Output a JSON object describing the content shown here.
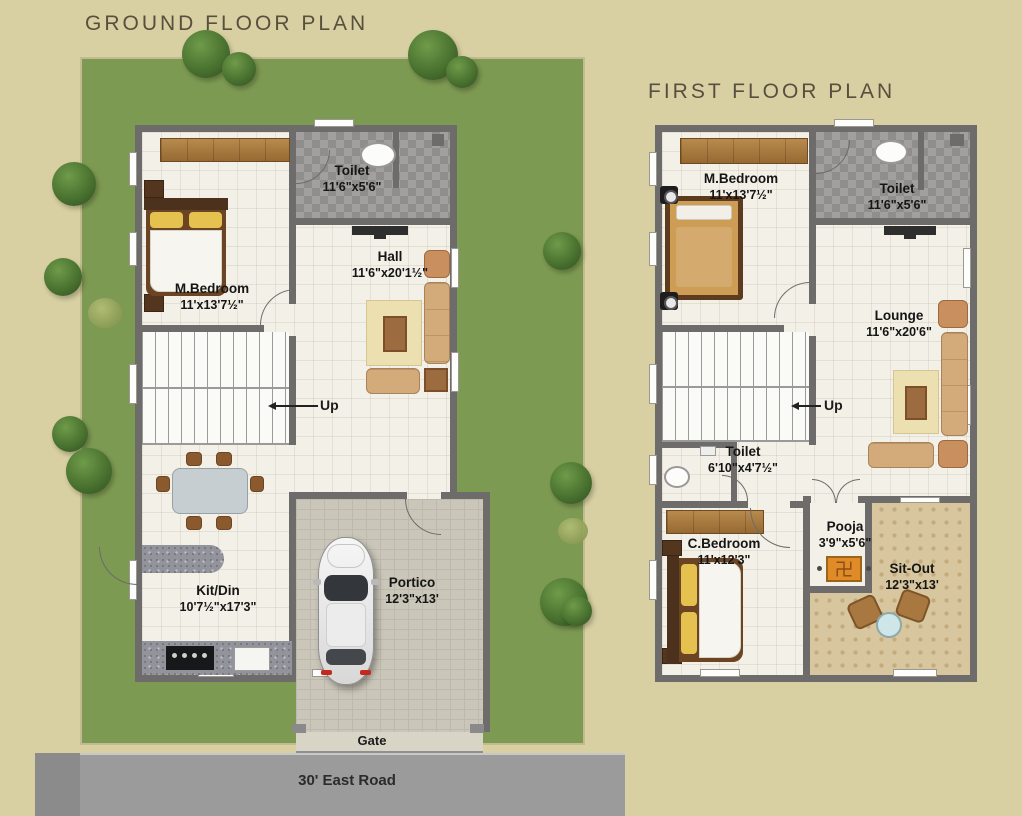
{
  "ground": {
    "title": "GROUND FLOOR PLAN",
    "mbedroom": {
      "name": "M.Bedroom",
      "dims": "11'x13'7½\""
    },
    "toilet": {
      "name": "Toilet",
      "dims": "11'6\"x5'6\""
    },
    "hall": {
      "name": "Hall",
      "dims": "11'6\"x20'1½\""
    },
    "kitdin": {
      "name": "Kit/Din",
      "dims": "10'7½\"x17'3\""
    },
    "portico": {
      "name": "Portico",
      "dims": "12'3\"x13'"
    },
    "up": "Up",
    "gate": "Gate",
    "road": "30' East Road"
  },
  "first": {
    "title": "FIRST FLOOR PLAN",
    "mbedroom": {
      "name": "M.Bedroom",
      "dims": "11'x13'7½\""
    },
    "toilet": {
      "name": "Toilet",
      "dims": "11'6\"x5'6\""
    },
    "lounge": {
      "name": "Lounge",
      "dims": "11'6\"x20'6\""
    },
    "toilet2": {
      "name": "Toilet",
      "dims": "6'10\"x4'7½\""
    },
    "cbedroom": {
      "name": "C.Bedroom",
      "dims": "11'x12'3\""
    },
    "pooja": {
      "name": "Pooja",
      "dims": "3'9\"x5'6\""
    },
    "sitout": {
      "name": "Sit-Out",
      "dims": "12'3\"x13'"
    },
    "up": "Up"
  },
  "icons": {
    "pooja_symbol": "swastika-icon"
  },
  "colors": {
    "background": "#d8d0a2",
    "lawn": "#7d9a52",
    "road": "#9b9b9b",
    "wall": "#6e6c6a",
    "wood": "#a5773f",
    "pooja_tile": "#e08b28"
  }
}
